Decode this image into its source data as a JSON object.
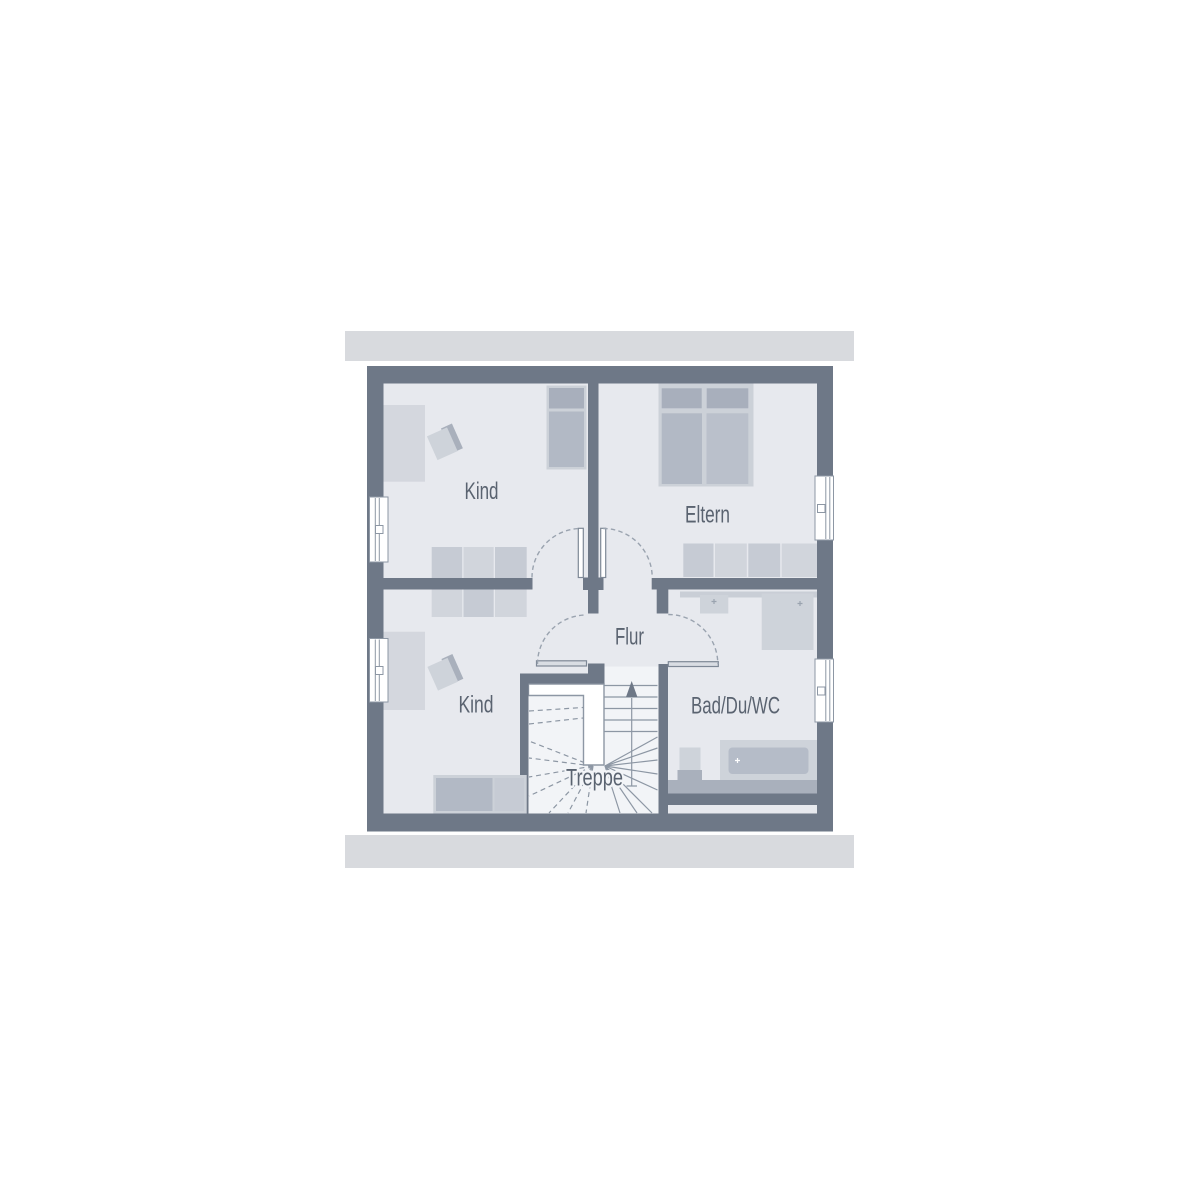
{
  "rooms": {
    "kind_top": {
      "label": "Kind"
    },
    "eltern": {
      "label": "Eltern"
    },
    "flur": {
      "label": "Flur"
    },
    "kind_bottom": {
      "label": "Kind"
    },
    "bad": {
      "label": "Bad/Du/WC"
    },
    "treppe": {
      "label": "Treppe"
    }
  },
  "palette": {
    "band": "#d8dade",
    "wall": "#6e7887",
    "floor": "#e7e9ee",
    "stair-floor": "#f2f4f7",
    "furn-light": "#d4d7de",
    "ward-a": "#c6cbd4",
    "ward-b": "#d1d5dc",
    "bed-border": "#ccd1d8",
    "pillow": "#a8afbc",
    "mattress": "#b2b9c5",
    "mattress2": "#bac0cb",
    "fixture": "#ced3da",
    "tub-inner": "#b5bcc8",
    "base-dark": "#a9b0bc",
    "knee": "#a9b0bc",
    "strip": "#c9ced6",
    "line": "#8d97a4",
    "arc": "#9aa3af",
    "leaf": "#d9dde3",
    "leaf-border": "#7e8896",
    "text": "#5a6370"
  }
}
